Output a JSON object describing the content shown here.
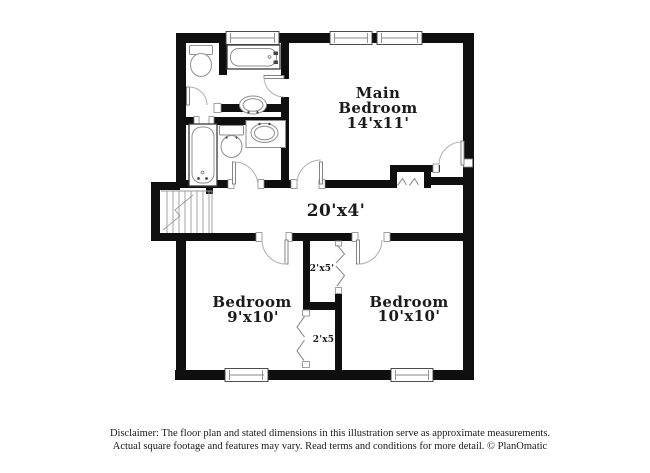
{
  "plan": {
    "rooms": {
      "main_bedroom": {
        "name_line1": "Main",
        "name_line2": "Bedroom",
        "dims": "14'x11'"
      },
      "bedroom9": {
        "name": "Bedroom",
        "dims": "9'x10'"
      },
      "bedroom10": {
        "name": "Bedroom",
        "dims": "10'x10'"
      },
      "hallway": {
        "dims": "20'x4'"
      },
      "closet_upper": {
        "dims": "2'x5'"
      },
      "closet_lower": {
        "dims": "2'x5'"
      }
    },
    "colors": {
      "wall": "#0f0f0f",
      "fixture_line": "#8f8f8f",
      "door_arc": "#b0b0b0",
      "text": "#1b1b1b",
      "background": "#ffffff"
    }
  },
  "footer": {
    "disclaimer_line1": "Disclaimer: The floor plan and stated dimensions in this illustration serve as approximate measurements.",
    "disclaimer_line2": "Actual square footage and features may vary. Read terms and conditions for more detail. © PlanOmatic"
  }
}
